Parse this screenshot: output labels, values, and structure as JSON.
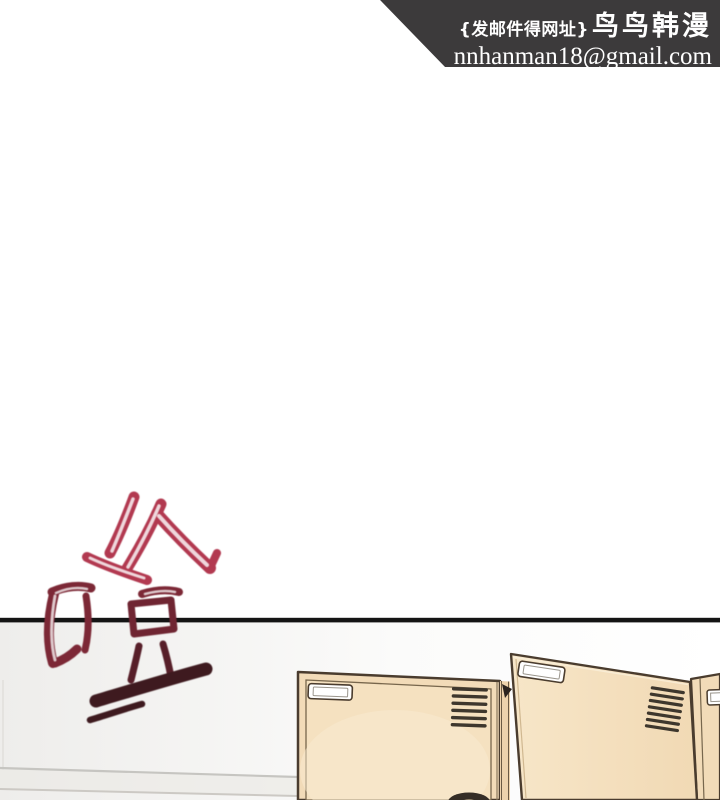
{
  "page": {
    "background": "#ffffff",
    "width": 720,
    "height": 800
  },
  "banner": {
    "background": "#3c3a3b",
    "text_color": "#ffffff",
    "note": "{发邮件得网址}",
    "brand": "鸟鸟韩漫",
    "email": "nnhanman18@gmail.com"
  },
  "sfx": {
    "character": "噔",
    "color_top": "#b23950",
    "color_mid": "#7c2836",
    "color_box": "#6f2532",
    "color_dots": "#571f29",
    "color_bottom": "#3e1a1f"
  },
  "scene": {
    "divider_color": "#141414",
    "locker_fill": "#f2dbb8",
    "locker_inner_fill": "#f5e1c0",
    "door_fill": "#f5e2c2",
    "frame_strip_fill": "#eed3ab",
    "locker_outline": "#4a3c2e",
    "vent_color": "#3e372d",
    "label_plate_color": "#ffffff",
    "handle_color": "#352d26",
    "wall_line_color": "#c6c5c1",
    "left_locker_vent_slats": 6,
    "door_vent_slats": 7
  }
}
